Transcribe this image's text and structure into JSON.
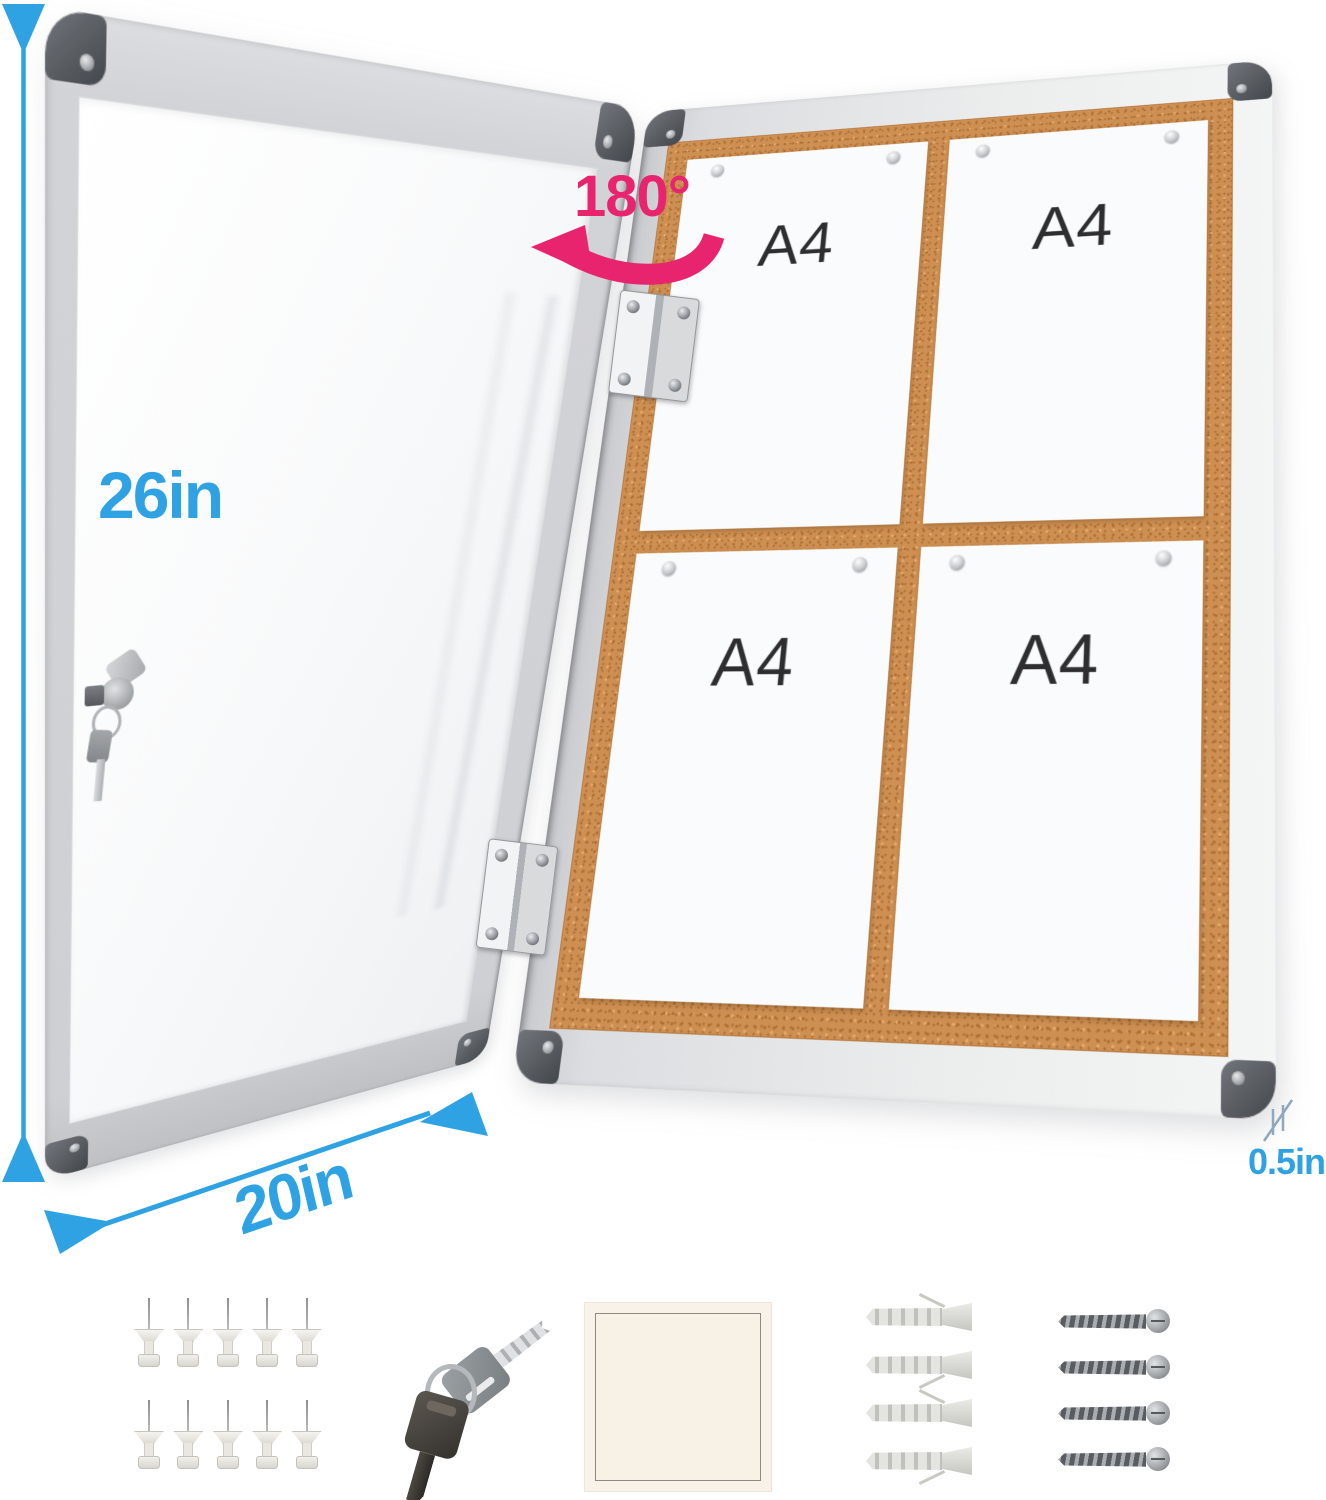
{
  "colors": {
    "annotation_blue": "#2EA2E2",
    "annotation_pink": "#E8246F",
    "thickness_marker": "#8FA8BC",
    "cork": "#CE8F52",
    "frame_silver": "#DCDDDF",
    "corner_cap_gray": "#5C6065",
    "paper_white": "#FAFBFC",
    "label_dark": "#2E2E30"
  },
  "labels": {
    "height": "26in",
    "width": "20in",
    "thickness": "0.5in",
    "rotation": "180°"
  },
  "board": {
    "papers": [
      {
        "label": "A4"
      },
      {
        "label": "A4"
      },
      {
        "label": "A4"
      },
      {
        "label": "A4"
      }
    ]
  },
  "accessories": {
    "push_pins": {
      "count": 10
    },
    "keys": {
      "count": 2
    },
    "adhesive_pad": {
      "count": 1
    },
    "wall_anchors": {
      "count": 4
    },
    "screws": {
      "count": 4
    }
  }
}
